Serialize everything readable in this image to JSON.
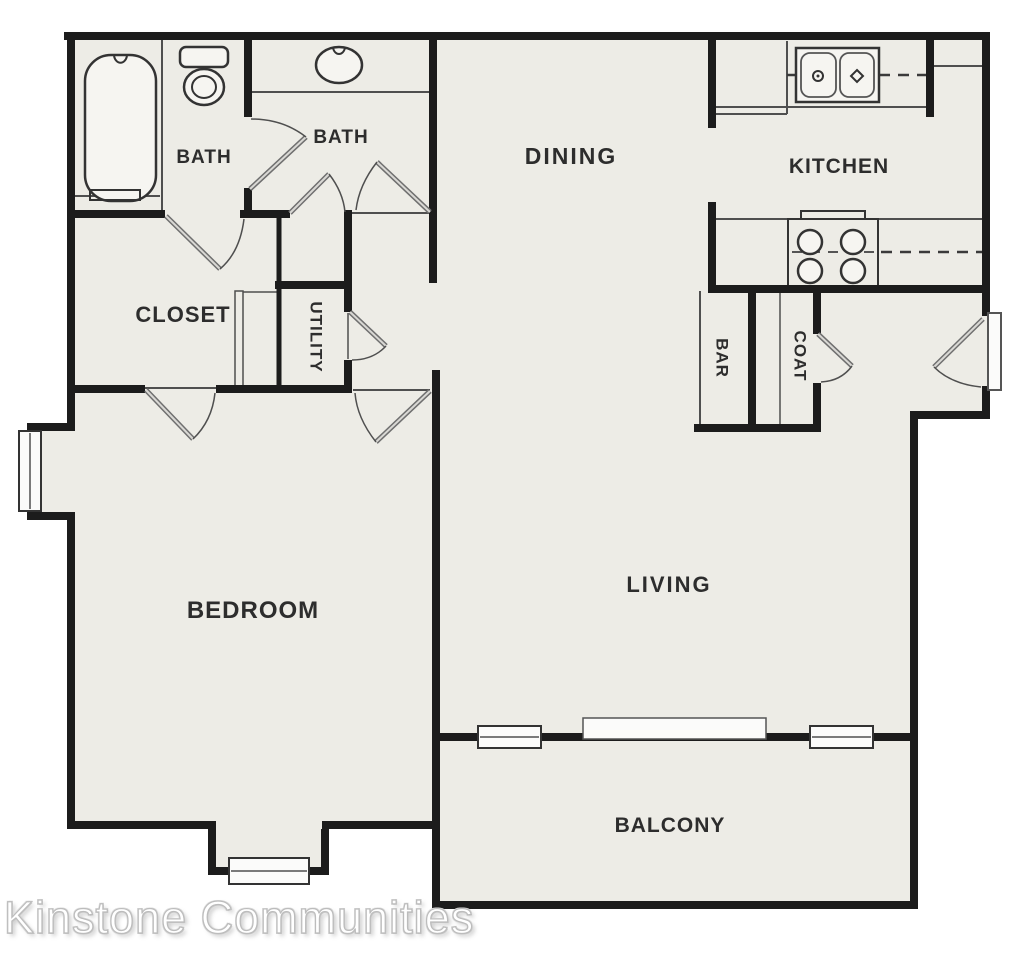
{
  "watermark": "Kinstone Communities",
  "rooms": {
    "bath1": "BATH",
    "bath2": "BATH",
    "dining": "DINING",
    "kitchen": "KITCHEN",
    "closet": "CLOSET",
    "utility": "UTILITY",
    "bar": "BAR",
    "coat": "COAT",
    "bedroom": "BEDROOM",
    "living": "LIVING",
    "balcony": "BALCONY"
  },
  "fixtures": [
    "bathtub",
    "toilet",
    "vanity-sink",
    "double-basin-kitchen-sink",
    "stove-four-burners",
    "sliding-glass-door",
    "window",
    "entry-door"
  ],
  "colors": {
    "floor": "#edece6",
    "wall": "#1c1c1c",
    "line": "#4f4f4f",
    "label": "#2d2d2d",
    "fixture": "#f6f5f1",
    "window": "#fbfbfa"
  }
}
